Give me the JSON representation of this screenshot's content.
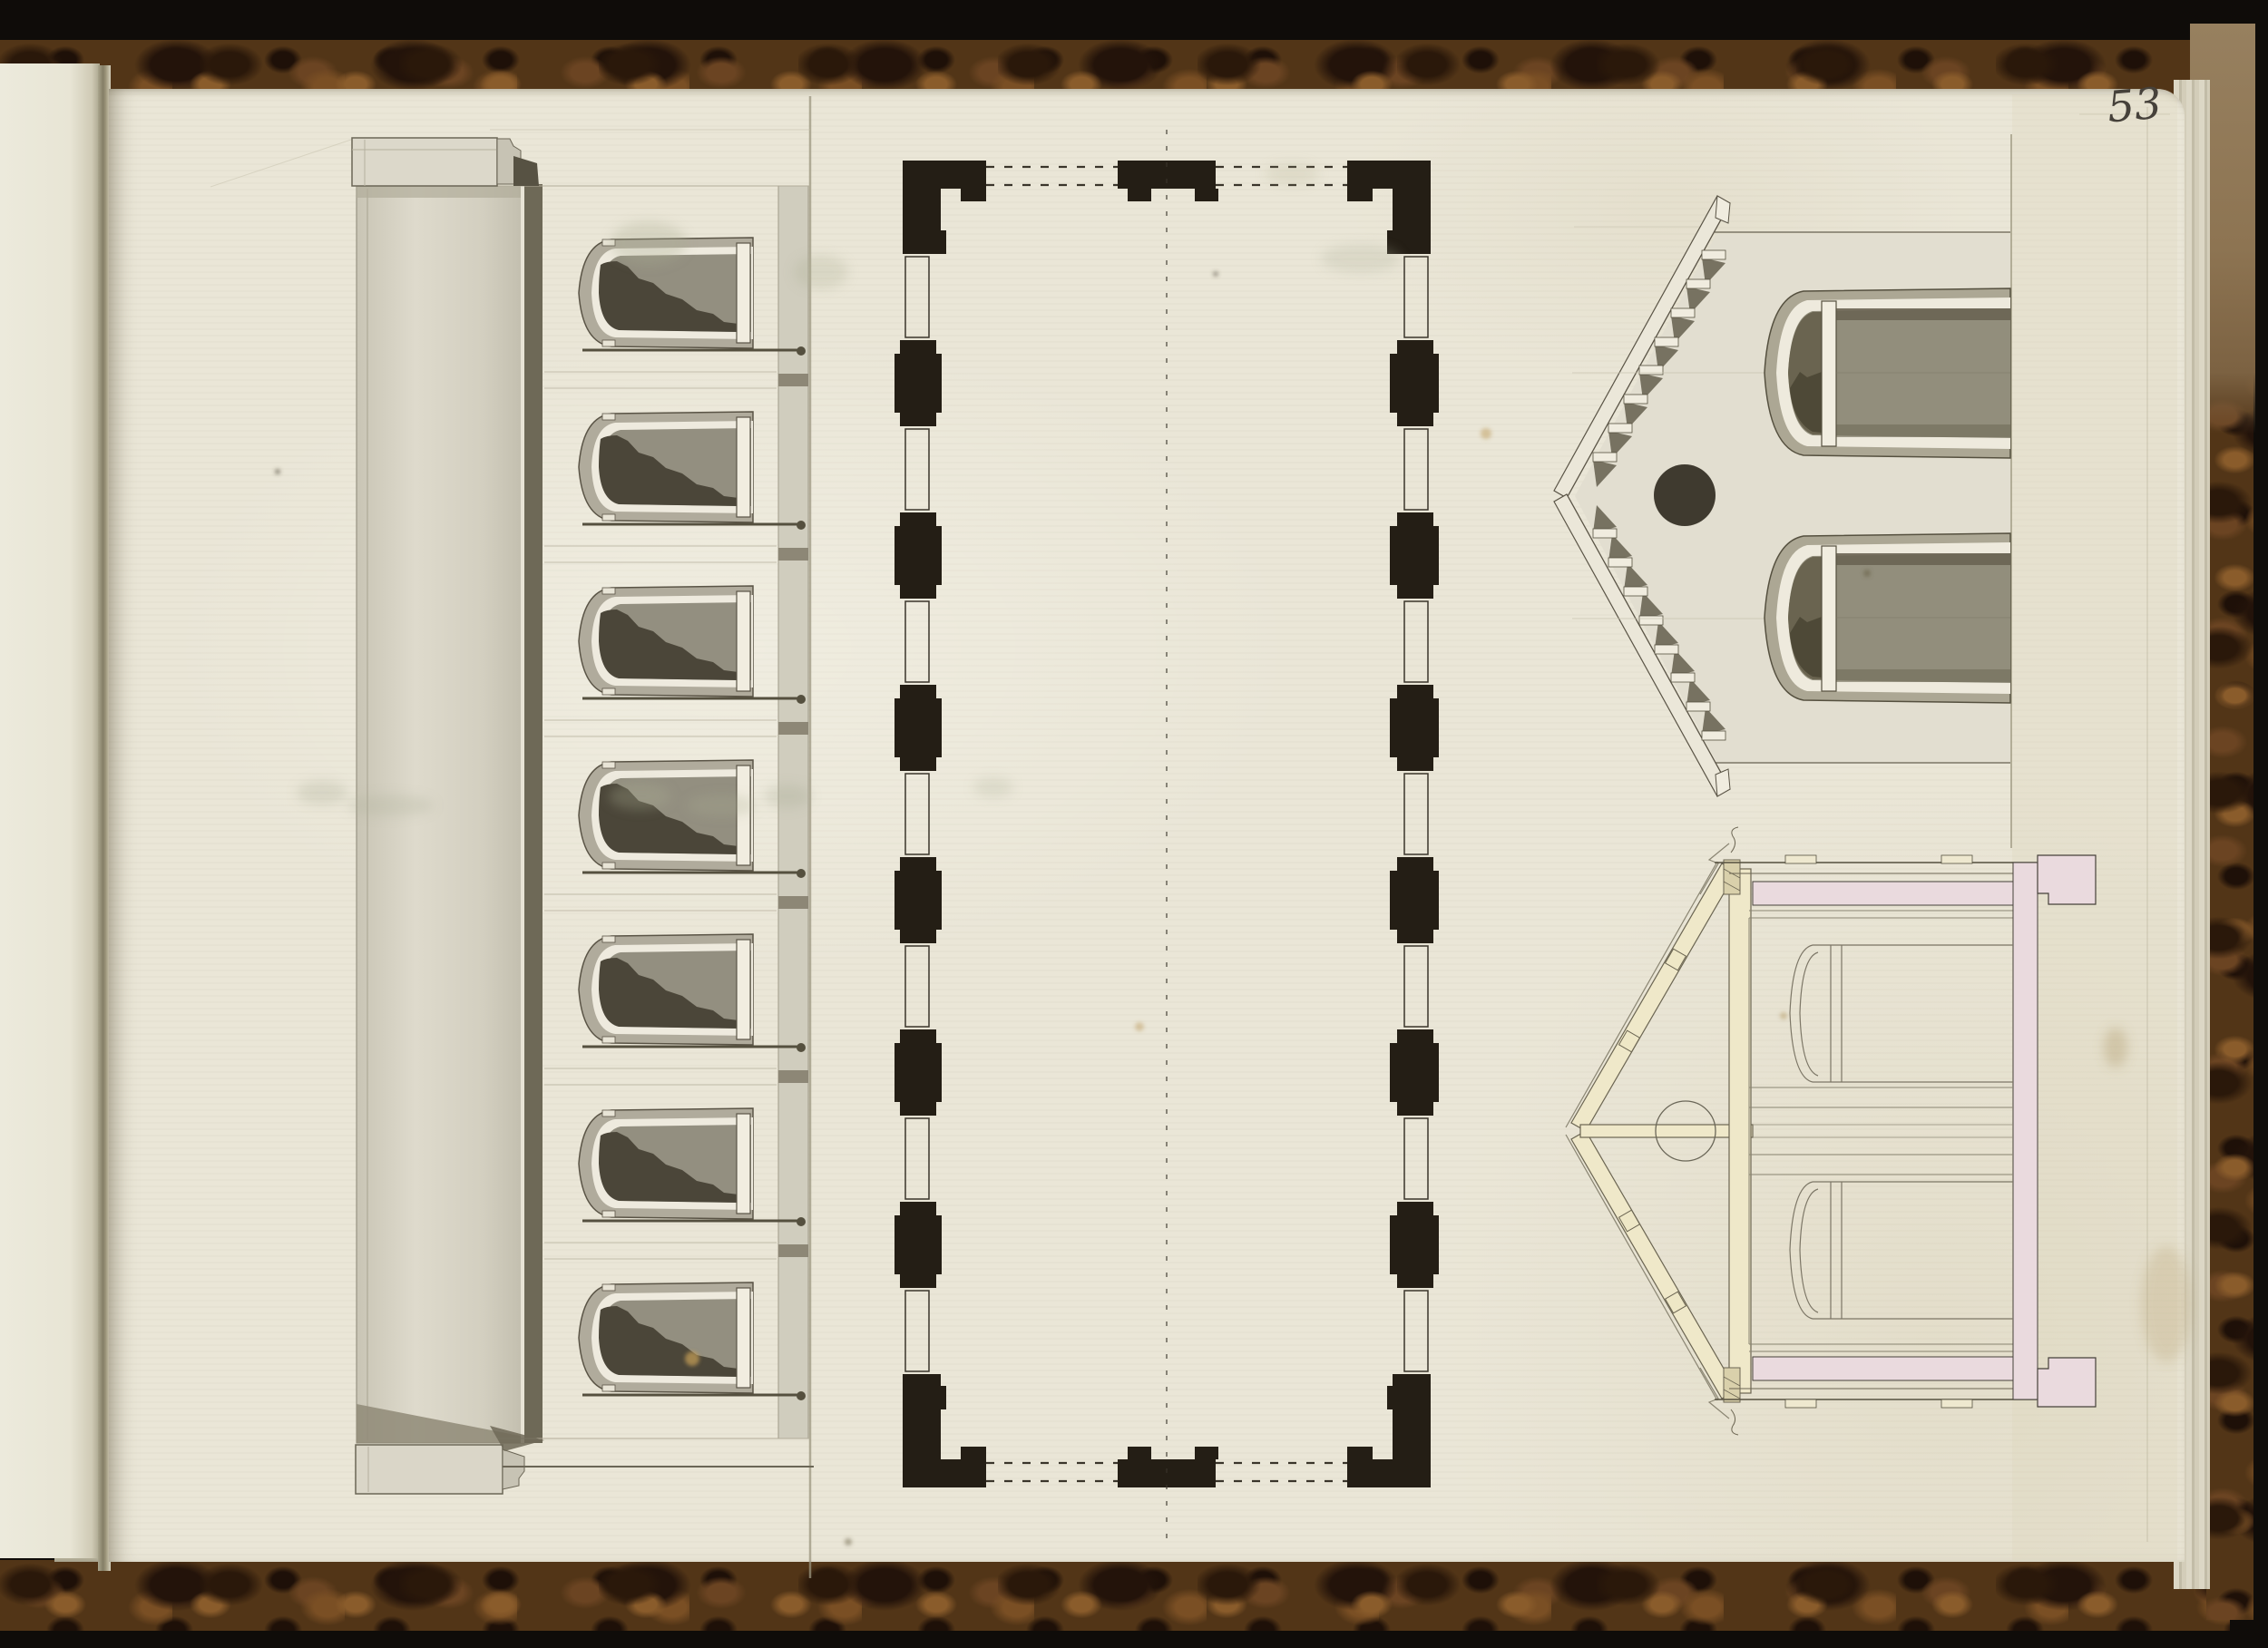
{
  "page": {
    "number": "53"
  },
  "drawings": {
    "left": "side-elevation",
    "center": "floor-plan",
    "top_right": "gable-end-elevation",
    "bottom_right": "cross-section"
  },
  "palette": {
    "background_black": "#0f0c09",
    "leather_brown": "#523517",
    "leather_vein": "#9c6a33",
    "paper_cream": "#eae6d7",
    "ink_dark": "#46413a",
    "plan_black": "#241e15",
    "wash_light": "#d5d1c3",
    "wash_mid": "#938f80",
    "wash_dark": "#4b4639",
    "eave_olive": "#6e6957",
    "wood_cream": "#efe8c9",
    "masonry_pink": "#eadade"
  }
}
